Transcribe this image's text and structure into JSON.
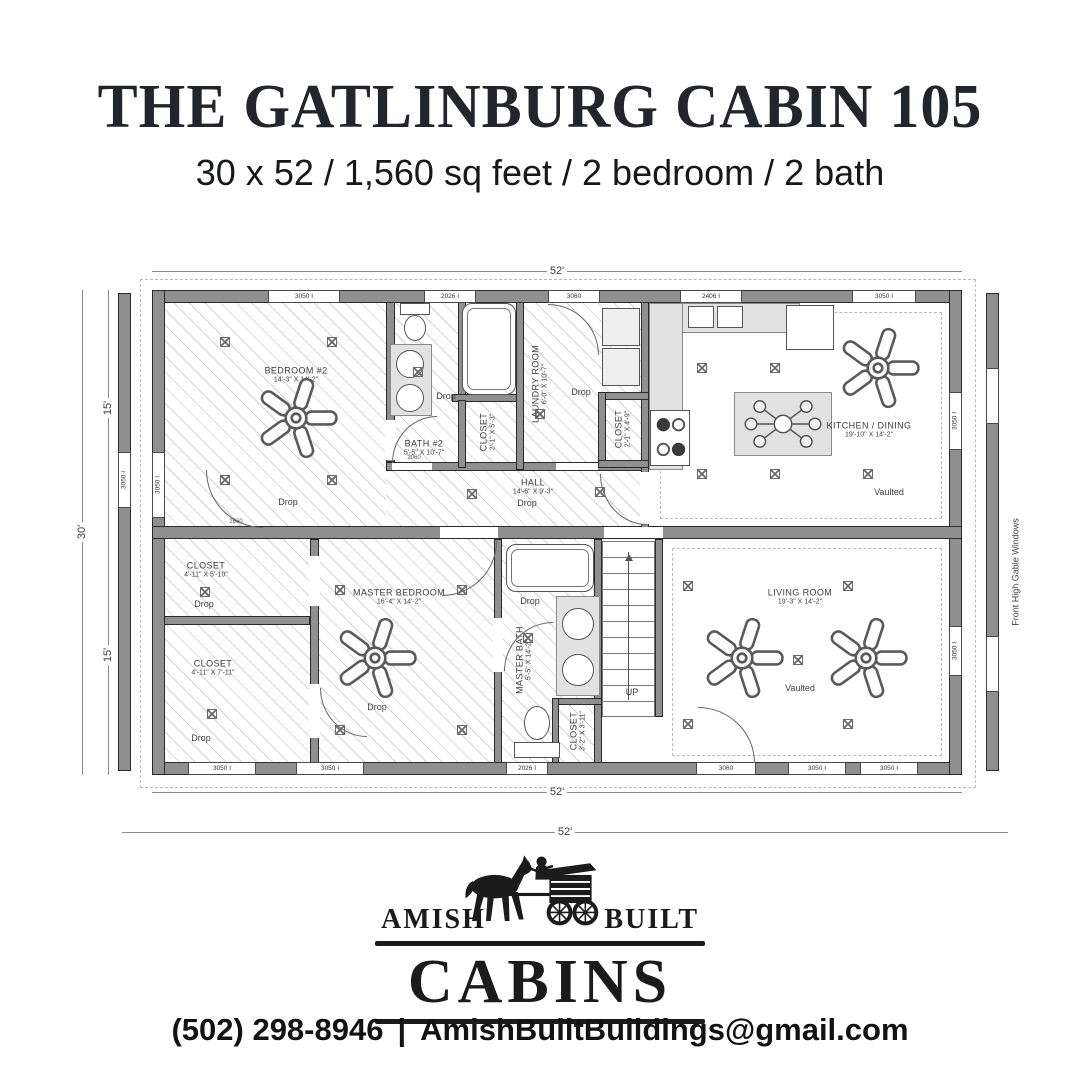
{
  "header": {
    "title": "THE GATLINBURG CABIN 105",
    "subtitle": "30 x 52 / 1,560 sq feet / 2 bedroom / 2 bath"
  },
  "plan": {
    "dims": {
      "top": "52'",
      "bottom": "52'",
      "bottom_outer": "52'",
      "left_total": "30'",
      "left_upper": "15'",
      "left_lower": "15'"
    },
    "side_note": "Front High Gable Windows",
    "stairs_label": "UP",
    "rooms": {
      "bedroom2": {
        "name": "BEDROOM #2",
        "dims": "14'-3\" X 14'-2\"",
        "note": "Drop"
      },
      "bath2": {
        "name": "BATH #2",
        "dims": "5'-5\" X 10'-7\"",
        "note": "Drop"
      },
      "closet_bath2": {
        "name": "CLOSET",
        "dims": "2'-1\" X 5'-3\""
      },
      "laundry": {
        "name": "LAUNDRY ROOM",
        "dims": "6'-0\" X 10'-7\"",
        "note": "Drop"
      },
      "closet_hall": {
        "name": "CLOSET",
        "dims": "2'-1\" X 4'-9\""
      },
      "kitchen": {
        "name": "KITCHEN / DINING",
        "dims": "19'-10\" X 14'-2\"",
        "note": "Vaulted"
      },
      "hall": {
        "name": "HALL",
        "dims": "14'-6\" X 9'-3\"",
        "note": "Drop"
      },
      "closet_upper_left": {
        "name": "CLOSET",
        "dims": "4'-11\" X 5'-10\"",
        "note": "Drop"
      },
      "closet_lower_left": {
        "name": "CLOSET",
        "dims": "4'-11\" X 7'-11\"",
        "note": "Drop"
      },
      "master_bedroom": {
        "name": "MASTER BEDROOM",
        "dims": "16'-4\" X 14'-2\"",
        "note": "Drop"
      },
      "master_bath": {
        "name": "MASTER BATH",
        "dims": "5'-5\" X 14'-2\"",
        "note": "Drop"
      },
      "closet_master_bath": {
        "name": "CLOSET",
        "dims": "3'-2\" X 3'-11\""
      },
      "living": {
        "name": "LIVING ROOM",
        "dims": "19'-3\" X 14'-2\"",
        "note": "Vaulted"
      }
    },
    "windows": {
      "top": [
        "3050 I",
        "2026 I",
        "3060",
        "2406 I",
        "3050 I"
      ],
      "bottom": [
        "3050 I",
        "3050 I",
        "2026 I",
        "3060",
        "3050 I",
        "3050 I"
      ],
      "left_wall": "3050 I",
      "left_gable": "3050 I",
      "right_upper": "3050 I",
      "right_lower": "3050 I"
    },
    "door_labels": [
      "2060",
      "2660"
    ]
  },
  "logo": {
    "amish": "AMISH",
    "built": "BUILT",
    "cabins": "CABINS"
  },
  "footer": {
    "phone": "(502) 298-8946",
    "separator": "|",
    "email": "AmishBuiltBuildings@gmail.com"
  }
}
